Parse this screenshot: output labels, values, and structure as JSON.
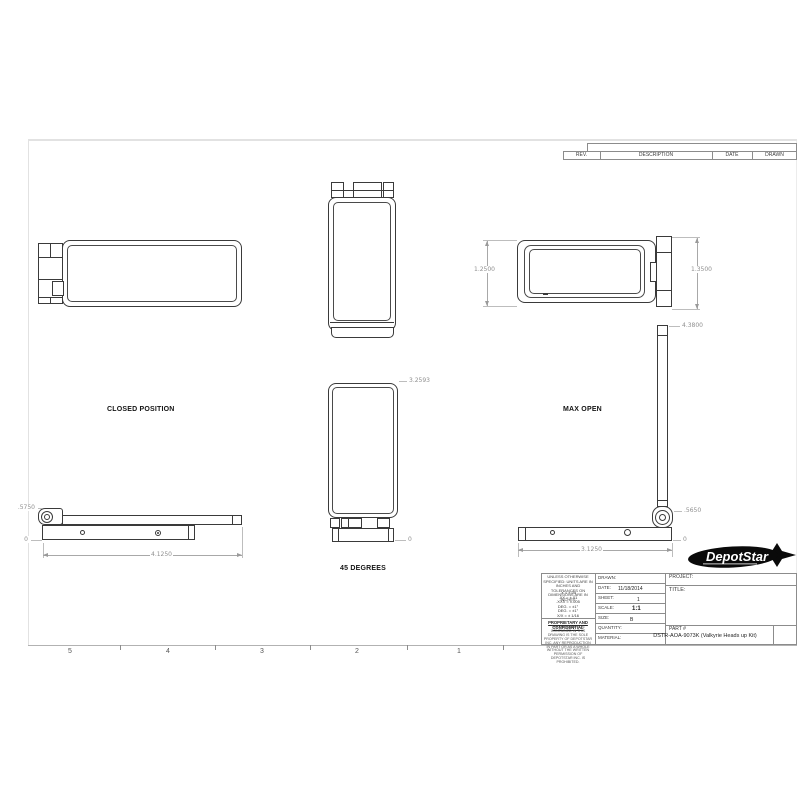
{
  "drawing": {
    "rev_table": {
      "headers": [
        "REV.",
        "DESCRIPTION",
        "DATE",
        "DRAWN"
      ]
    },
    "zones": [
      "5",
      "4",
      "3",
      "2",
      "1"
    ],
    "views": {
      "closed_label": "CLOSED POSITION",
      "deg45_label": "45 DEGREES",
      "max_open_label": "MAX OPEN"
    },
    "dims": {
      "end_left": "1.2500",
      "end_right": "1.3500",
      "deg45_height": "3.2593",
      "deg45_zero": "0",
      "closed_height": ".5750",
      "closed_zero": "0",
      "closed_length": "4.1250",
      "open_height": "4.3800",
      "open_hinge": ".5650",
      "open_zero": "0",
      "open_length": "3.1250"
    },
    "title_block": {
      "general_note": "UNLESS OTHERWISE SPECIFIED: UNITS ARE IN INCHES AND TOLERANCES ON DIMENSIONS ARE IN INCHES",
      "tolerances": [
        ".X = ±.05",
        ".XX = ±.01",
        ".XXX = ±.005",
        "DEG. = ±1°",
        "DEG. = ±1°",
        "X/X = ± 1/16"
      ],
      "proprietary_title": "PROPRIETARY AND CONFIDENTIAL",
      "proprietary_text": "THE INFORMATION CONTAINED IN THIS DRAWING IS THE SOLE PROPERTY OF DEPOTSTAR INC. ANY REPRODUCTION IN PART OR AS A WHOLE WITHOUT THE WRITTEN PERMISSION OF DEPOTSTAR INC. IS PROHIBITED.",
      "drawn_label": "DRAWN:",
      "date_label": "DATE:",
      "date_value": "11/18/2014",
      "sheet_label": "SHEET:",
      "sheet_value": "1",
      "scale_label": "SCALE:",
      "scale_value": "1:1",
      "size_label": "SIZE:",
      "size_value": "B",
      "quantity_label": "QUANTITY:",
      "material_label": "MATERIAL:",
      "project_label": "PROJECT:",
      "title_label": "TITLE:",
      "part_label": "PART #",
      "part_value": "DSTR-AOA-9073K (Valkyrie Heads up Kit)"
    },
    "logo": {
      "text": "DepotStar"
    }
  }
}
